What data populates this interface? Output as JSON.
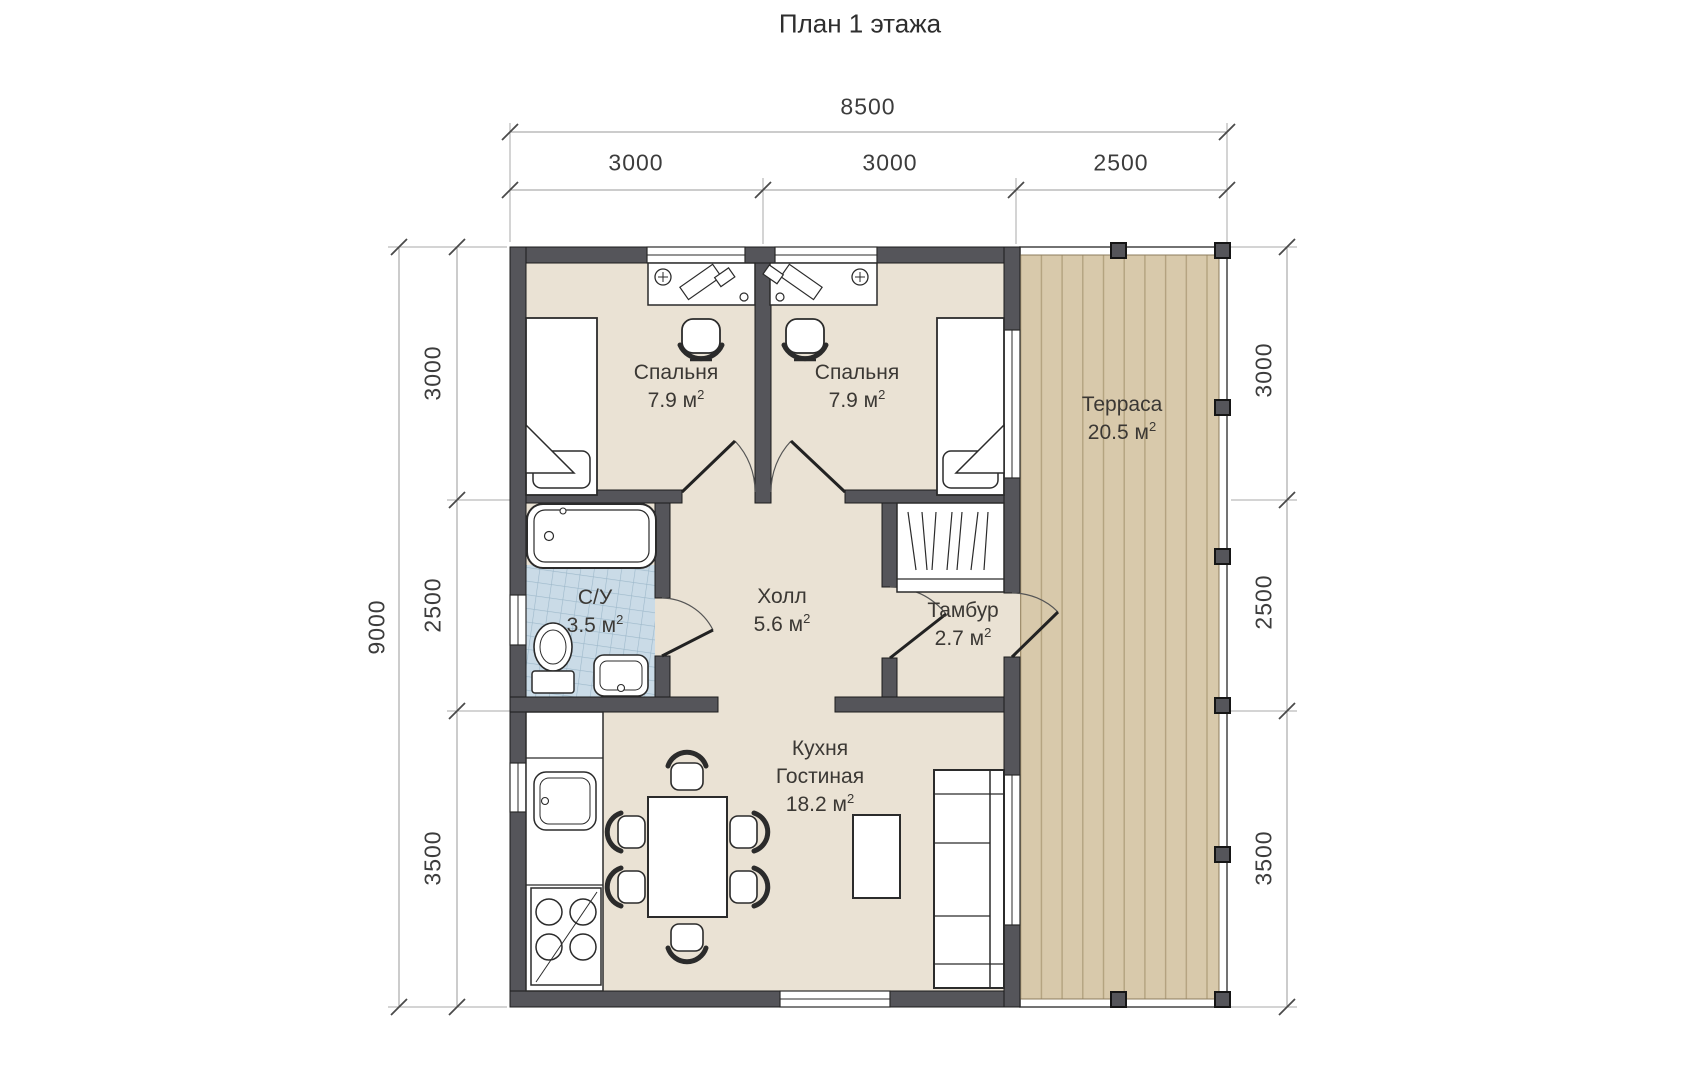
{
  "title": "План 1 этажа",
  "dimensions": {
    "top_total": "8500",
    "top_segments": [
      "3000",
      "3000",
      "2500"
    ],
    "left_total": "9000",
    "left_segments": [
      "3000",
      "2500",
      "3500"
    ],
    "right_segments": [
      "3000",
      "2500",
      "3500"
    ]
  },
  "rooms": {
    "bedroom1": {
      "name": "Спальня",
      "area": "7.9 м",
      "sup": "2"
    },
    "bedroom2": {
      "name": "Спальня",
      "area": "7.9 м",
      "sup": "2"
    },
    "terrace": {
      "name": "Терраса",
      "area": "20.5 м",
      "sup": "2"
    },
    "bathroom": {
      "name": "С/У",
      "area": "3.5 м",
      "sup": "2"
    },
    "hall": {
      "name": "Холл",
      "area": "5.6 м",
      "sup": "2"
    },
    "tambur": {
      "name": "Тамбур",
      "area": "2.7 м",
      "sup": "2"
    },
    "kitchen": {
      "name1": "Кухня",
      "name2": "Гостиная",
      "area": "18.2 м",
      "sup": "2"
    }
  },
  "colors": {
    "wall": "#55555a",
    "floor": "#eae2d4",
    "terrace_wood": "#d8c9ab",
    "bathroom_tile": "#cadbe7",
    "furniture_outline": "#2b2b2b",
    "dimension_line": "#9a9a9a"
  }
}
